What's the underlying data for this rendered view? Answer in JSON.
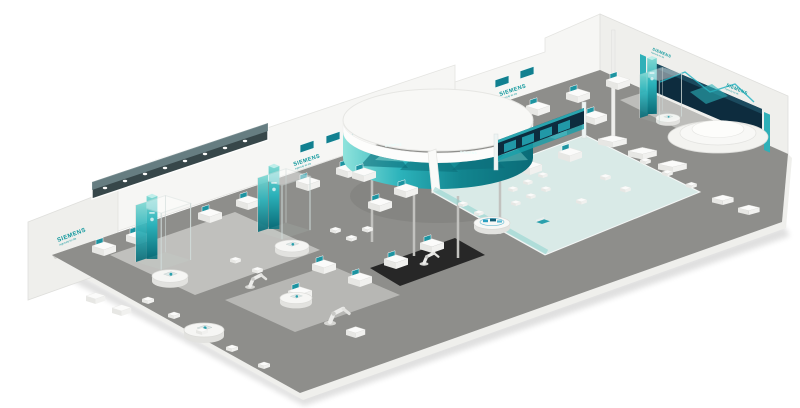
{
  "branding": {
    "logo": "SIEMENS",
    "tagline": "Ingenuity for life"
  },
  "colors": {
    "background": "#ffffff",
    "petrol": "#10989d",
    "teal_light": "#7fd8d2",
    "teal_mid": "#1ea7b0",
    "teal_deep": "#0a6b77",
    "wall": "#f6f6f4",
    "wall_shade": "#efefec",
    "floor": "#8e8e8b",
    "floor_light": "#c9c9c6",
    "demo_floor": "#d9eae7",
    "screen_dark": "#0d2c3e",
    "carpet": "#1e1e1e"
  }
}
